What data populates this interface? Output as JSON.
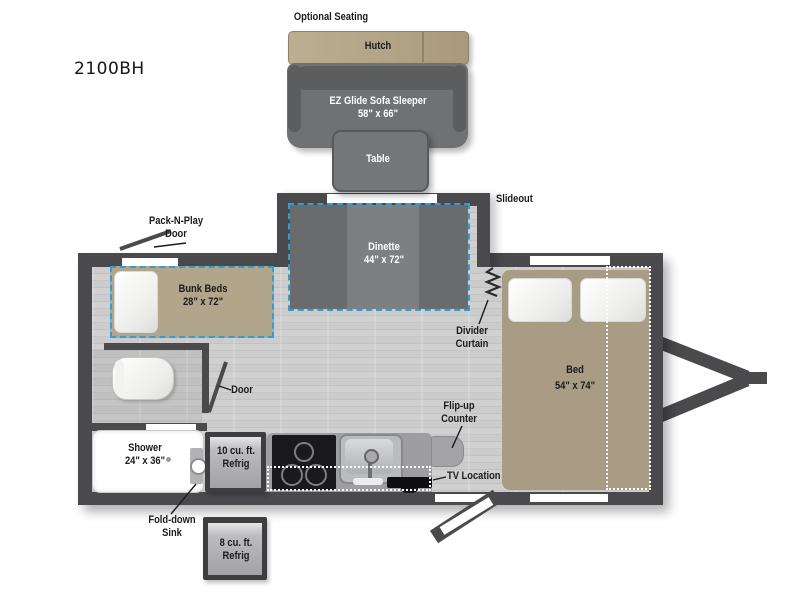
{
  "title": {
    "model": "2100BH"
  },
  "top_group": {
    "optional_seating": "Optional Seating",
    "hutch": "Hutch",
    "sofa": {
      "line1": "EZ Glide Sofa Sleeper",
      "line2": "58\" x 66\""
    },
    "table": "Table"
  },
  "plan": {
    "slideout": "Slideout",
    "dinette": {
      "line1": "Dinette",
      "line2": "44\" x 72\""
    },
    "pack_n_play": {
      "line1": "Pack-N-Play",
      "line2": "Door"
    },
    "bunk": {
      "line1": "Bunk Beds",
      "line2": "28\" x 72\""
    },
    "divider": {
      "line1": "Divider",
      "line2": "Curtain"
    },
    "door": "Door",
    "shower": {
      "line1": "Shower",
      "line2": "24\" x 36\""
    },
    "refrig10": {
      "line1": "10 cu. ft.",
      "line2": "Refrig"
    },
    "flip_up": {
      "line1": "Flip-up",
      "line2": "Counter"
    },
    "tv": "TV Location",
    "fold_down": {
      "line1": "Fold-down",
      "line2": "Sink"
    },
    "refrig8": {
      "line1": "8 cu. ft.",
      "line2": "Refrig"
    },
    "bed": {
      "line1": "Bed",
      "line2": "54\" x 74\""
    }
  },
  "colors": {
    "wall": "#4a4a4d",
    "floor": "#c9c9ca",
    "dash_accent": "#2e9ed6",
    "wood_tan": "#b1a58b",
    "bed_tan": "#a89c84",
    "sofa_gray": "#6f7173",
    "white": "#ffffff"
  }
}
